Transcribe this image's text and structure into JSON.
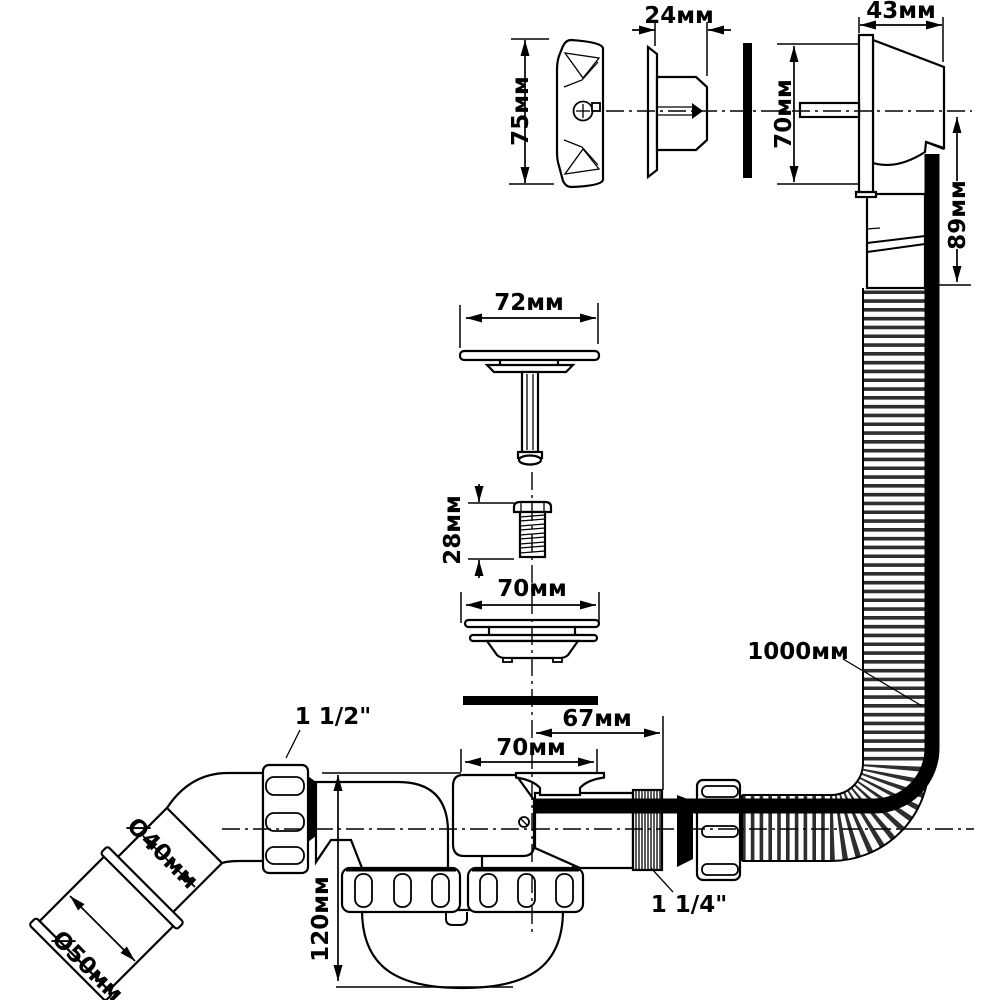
{
  "drawing": {
    "kind": "technical-dimension-diagram",
    "subject": "bath waste-overflow siphon exploded view",
    "units": "mm",
    "colors": {
      "background": "#ffffff",
      "line": "#000000",
      "corrugation": "#2e2e2e"
    },
    "dimensions": {
      "overflow_faceplate_height": "75мм",
      "overflow_insert_depth": "24мм",
      "overflow_housing_depth": "43мм",
      "overflow_housing_height": "70мм",
      "overflow_tail_length": "89мм",
      "plug_cover_diameter": "72мм",
      "plug_screw_length": "28мм",
      "strainer_diameter": "70мм",
      "tailpiece_length": "67мм",
      "drain_body_width": "70мм",
      "hose_length": "1000мм",
      "siphon_height": "120мм",
      "outlet_pipe_diameter": "Ø40мм",
      "adapter_sleeve_diameter": "Ø50мм",
      "inlet_nut_thread": "1 1/2\"",
      "outlet_thread": "1 1/4\""
    }
  }
}
